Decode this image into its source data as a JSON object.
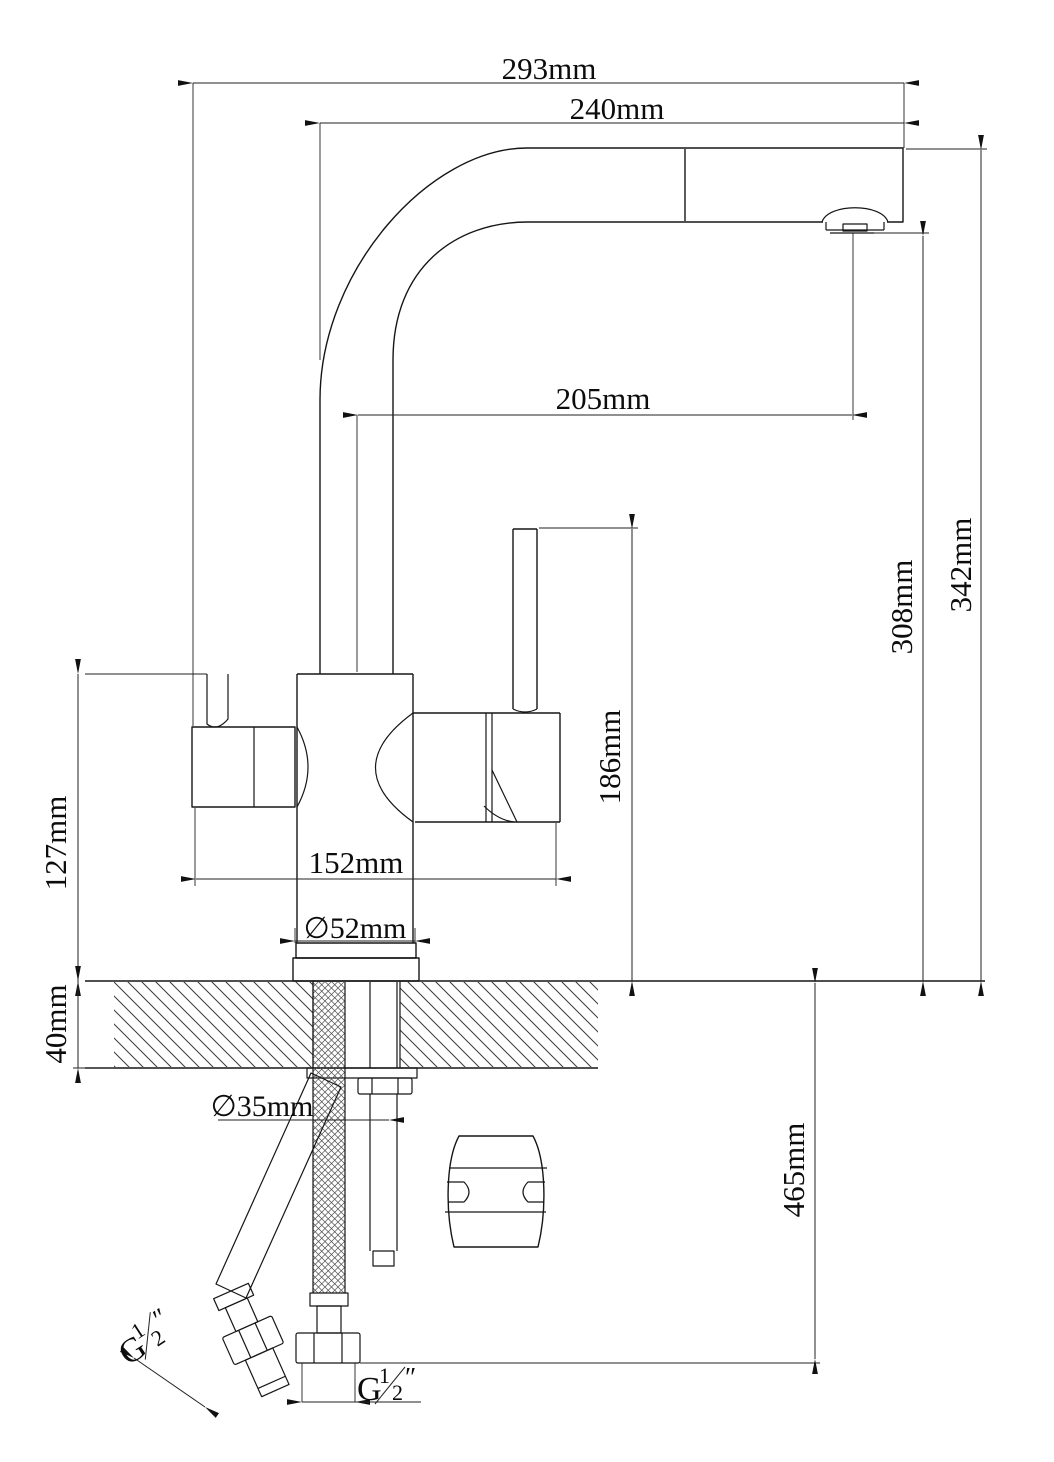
{
  "drawing": {
    "dim_labels": {
      "spout_reach_overall": "293mm",
      "spout_reach": "240mm",
      "spout_projection": "205mm",
      "height_overall": "342mm",
      "spout_outlet_height": "308mm",
      "lever_height": "186mm",
      "body_height": "127mm",
      "deck_thickness": "40mm",
      "body_width": "152mm",
      "base_diameter": "∅52mm",
      "hole_diameter": "∅35mm",
      "hose_length": "465mm"
    },
    "thread_label": {
      "prefix": "G",
      "numerator": "1",
      "denominator": "2",
      "unit": "″"
    }
  }
}
